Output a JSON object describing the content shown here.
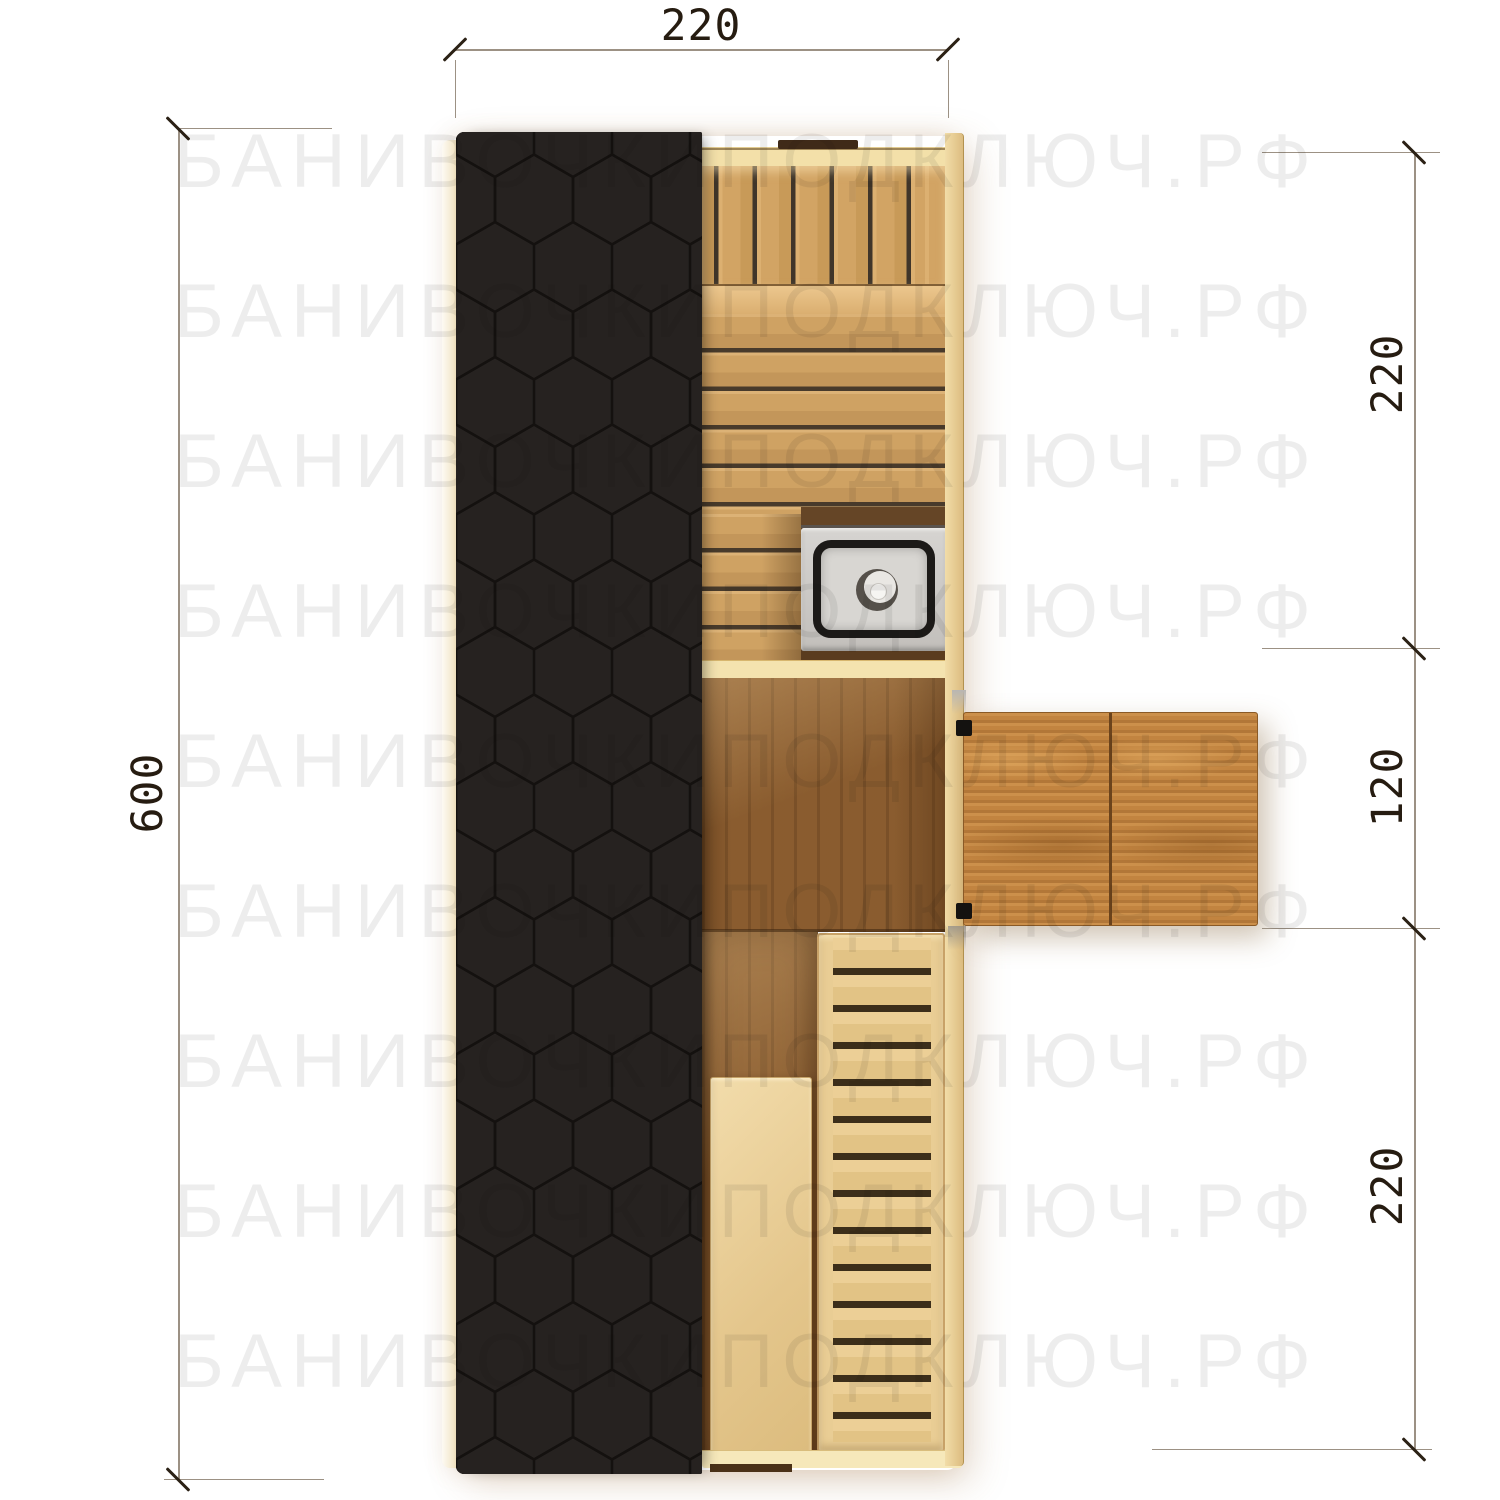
{
  "watermark": {
    "text": "БАНИВОЧКИПОДКЛЮЧ.РФ",
    "rows": 9
  },
  "dimensions": {
    "top_width": "220",
    "left_height": "600",
    "right_segments": [
      "220",
      "120",
      "220"
    ]
  },
  "colors": {
    "background": "#ffffff",
    "roof_shingles": "#262220",
    "roof_hex_outline": "#0d0a09",
    "wall_wood": "#f3e0a9",
    "bench_wood": "#d2a464",
    "floor_plank_wood": "#cfa263",
    "walnut_floor": "#8a5c2f",
    "porch_wood": "#c28440",
    "duckboard_wood": "#e9cd94",
    "stove_metal": "#d8d6d2",
    "stove_rim": "#1c1a18",
    "stove_platform": "#5f4022",
    "dimension_line": "#9c9184",
    "dimension_tick": "#2b2115",
    "dimension_text": "#261c11"
  }
}
